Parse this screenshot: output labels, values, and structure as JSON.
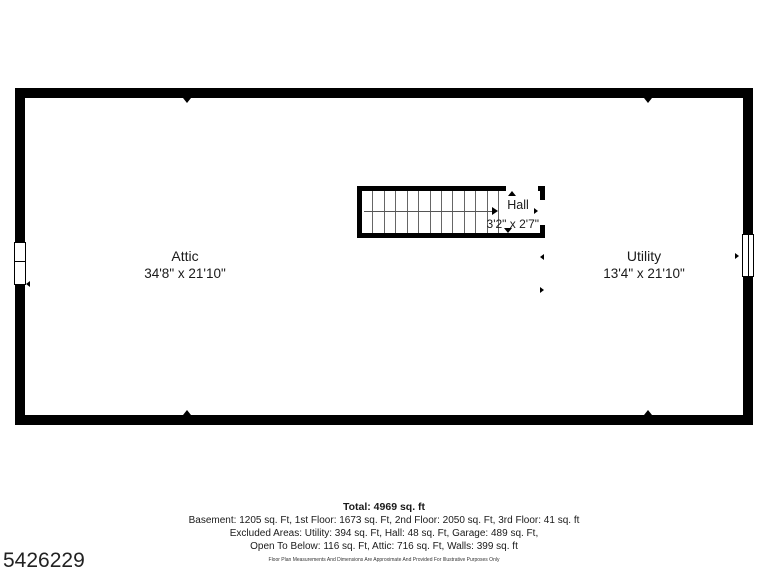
{
  "photo_id": "5426229",
  "rooms": {
    "attic": {
      "name": "Attic",
      "dimensions": "34'8\" x 21'10\""
    },
    "utility": {
      "name": "Utility",
      "dimensions": "13'4\" x 21'10\""
    },
    "hall": {
      "name": "Hall",
      "dimensions": "3'2\" x 2'7\""
    }
  },
  "stairs": {
    "treads": 12,
    "direction": "right"
  },
  "summary": {
    "total": "Total: 4969 sq. ft",
    "line1": "Basement: 1205 sq. Ft, 1st Floor: 1673 sq. Ft, 2nd Floor: 2050 sq. Ft, 3rd Floor: 41 sq. ft",
    "line2": "Excluded Areas: Utility: 394 sq. Ft, Hall: 48 sq. Ft, Garage: 489 sq. Ft,",
    "line3": "Open To Below: 116 sq. Ft, Attic: 716 sq. Ft, Walls: 399 sq. ft",
    "disclaimer": "Floor Plan Measurements And Dimensions Are Approximate And Provided For Illustrative Purposes Only"
  },
  "colors": {
    "wall": "#000000",
    "text": "#1a1a1a"
  }
}
